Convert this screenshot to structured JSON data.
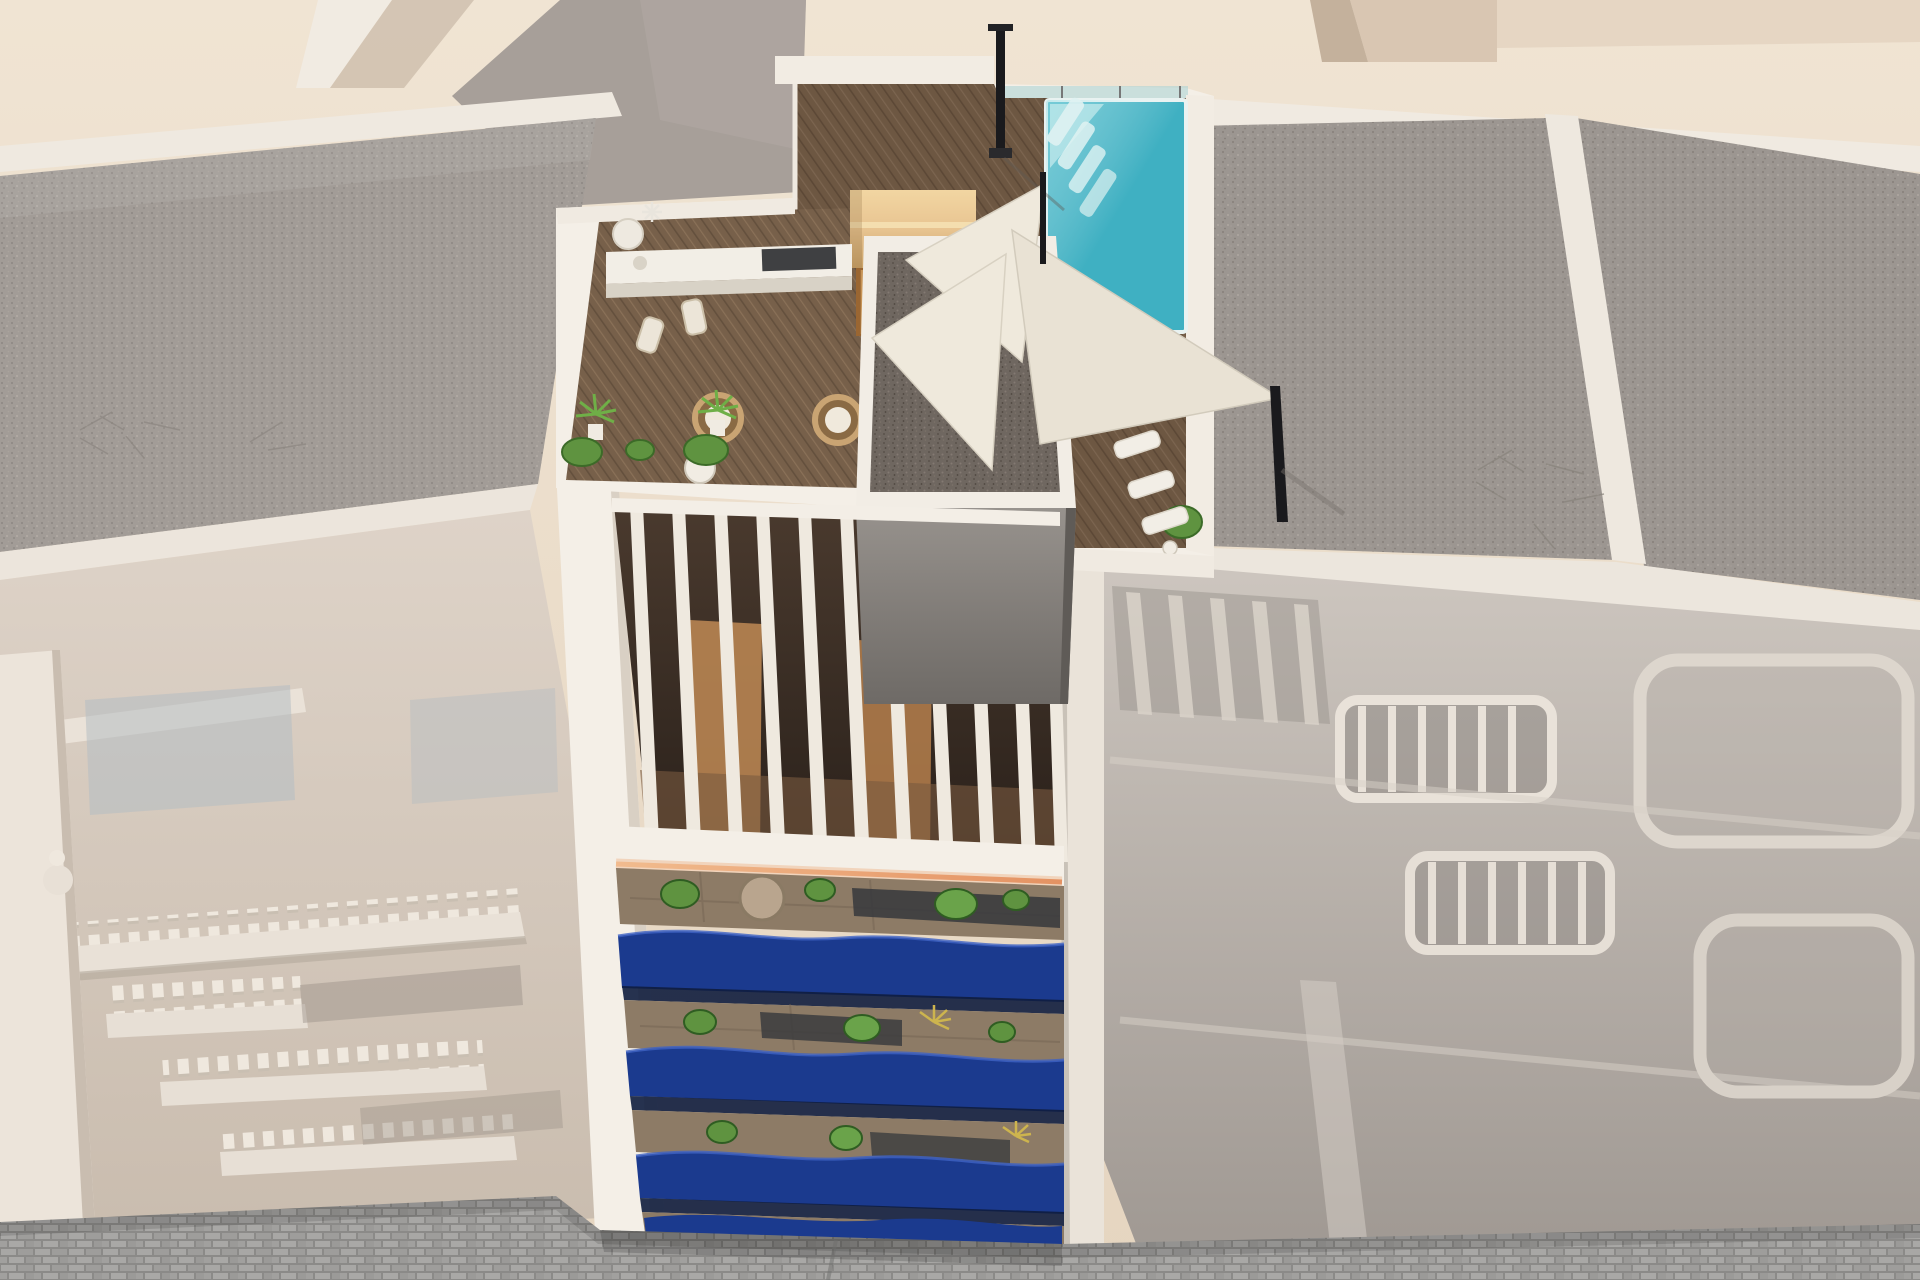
{
  "scene": {
    "type": "architectural-3d-render",
    "view": "aerial-top-down",
    "subject": "New-build apartment tower with rooftop pool terrace between faded neighbouring buildings",
    "center_building": {
      "rooftop": {
        "has_pool": true,
        "pool_loungers": 4,
        "sun_sails": 3,
        "sun_loungers": 5,
        "egg_chairs": 2,
        "sauna_cabin": 1,
        "outdoor_kitchen": 1,
        "shower_pole": 1,
        "planter_bushes": 6
      },
      "pergola_slats": 11,
      "balcony_levels": 4,
      "balcony_style": "wavy glossy blue fronts with plants",
      "led_strip": true
    },
    "left_building": {
      "style": "faded classic facade with balustrade balconies",
      "roof": "gravel"
    },
    "right_building": {
      "style": "faded facade with slat railings and rounded balconies",
      "roof": "gravel"
    },
    "street": "cobblestone pavement at bottom",
    "colors": {
      "background_beige": "#e9dbc8",
      "ground_light": "#f0e4d3",
      "courtyard_shadow": "#a79f99",
      "white_wall": "#f4efe7",
      "parapet_white": "#efe9e0",
      "gravel_light_base": "#a29c97",
      "gravel_right_base": "#9c9691",
      "gravel_dark_base": "#6f6760",
      "deck_dark_base": "#6d5742",
      "deck_mid_base": "#77604a",
      "sauna_wood": "#e8c491",
      "pool_water": "#3fb0c2",
      "pool_glass": "#aed3d6",
      "balcony_blue": "#1b3a8e",
      "balcony_blue_light": "#3f63c4",
      "plant_green": "#5f9340",
      "plant_green_dark": "#3c6b28",
      "sail_ivory": "#efe9dc",
      "led_warm": "#eda36f",
      "stone_floor": "#8d7b66",
      "glass_dark": "#36383c",
      "street_base": "#a3a2a0",
      "facade_left": "#d9cec3",
      "facade_right": "#c2bbb4",
      "pillar_white": "#ece4da",
      "metal_dark": "#1a1a1d"
    }
  }
}
